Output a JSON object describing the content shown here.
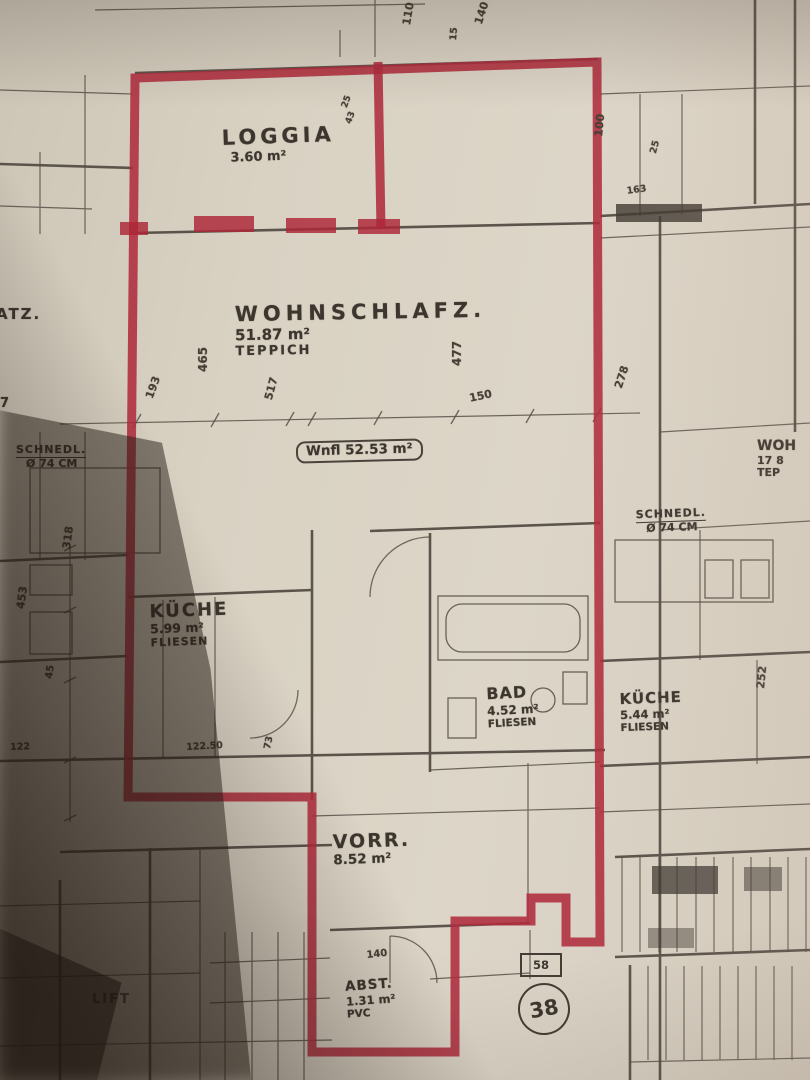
{
  "plan": {
    "rooms": {
      "loggia": {
        "name": "LOGGIA",
        "area": "3.60 m²"
      },
      "wohnschlaf": {
        "name": "WOHNSCHLAFZ.",
        "area": "51.87 m²",
        "floor": "TEPPICH"
      },
      "kueche_left": {
        "name": "KÜCHE",
        "area": "5.99 m²",
        "floor": "FLIESEN"
      },
      "bad": {
        "name": "BAD",
        "area": "4.52 m²",
        "floor": "FLIESEN"
      },
      "vorraum": {
        "name": "VORR.",
        "area": "8.52 m²"
      },
      "abstellraum": {
        "name": "ABST.",
        "area": "1.31 m²",
        "floor": "PVC"
      },
      "kueche_right": {
        "name": "KÜCHE",
        "area": "5.44 m²",
        "floor": "FLIESEN"
      },
      "wohn_right": {
        "name": "WOH",
        "line2": "17 8",
        "floor": "TEP"
      },
      "lift": {
        "name": "LIFT"
      },
      "platz_clipped": {
        "name": "ATZ.",
        "num": "7"
      }
    },
    "area_note": "Wnfl 52.53 m²",
    "unit_badge": {
      "number": "38",
      "door_width": "58"
    },
    "columns": {
      "left": {
        "line1": "SCHNEDL.",
        "line2": "Ø 74 CM"
      },
      "right": {
        "line1": "SCHNEDL.",
        "line2": "Ø 74 CM"
      }
    },
    "dimensions": {
      "d465": "465",
      "d193": "193",
      "d517": "517",
      "d477": "477",
      "d150": "150",
      "d278": "278",
      "d110": "110",
      "d15": "15",
      "d140_top": "140",
      "d100": "100",
      "d252": "252",
      "d122_50": "122.50",
      "d73": "73",
      "d318": "318",
      "d453": "453",
      "d45": "45",
      "d122": "122",
      "d140_bottom": "140",
      "d25": "25",
      "d43": "43",
      "d163": "163",
      "d25b": "25"
    },
    "colors": {
      "outline_red": "#b02c3e",
      "ink": "#46403a",
      "paper": "#d9d2c3"
    }
  }
}
